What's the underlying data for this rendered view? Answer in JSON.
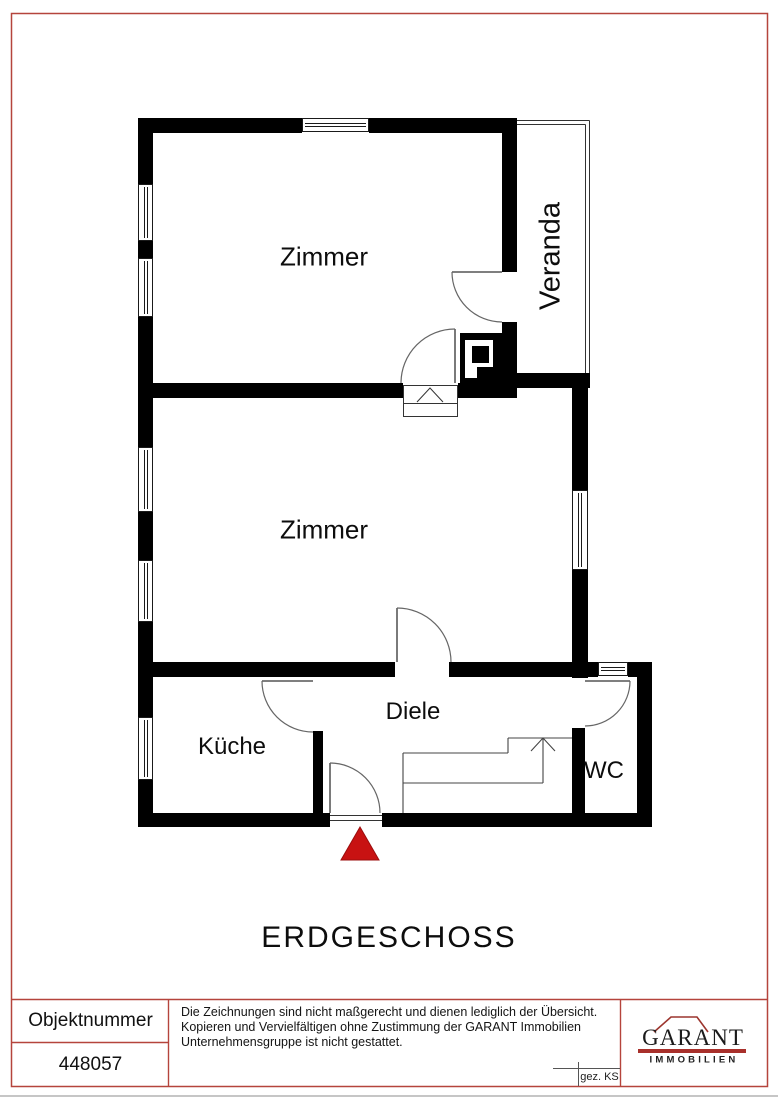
{
  "page": {
    "background": "#ffffff",
    "border_color": "#b5443c",
    "wall_color": "#000000"
  },
  "plan": {
    "title": "ERDGESCHOSS",
    "rooms": [
      {
        "id": "zimmer-top",
        "label": "Zimmer"
      },
      {
        "id": "veranda",
        "label": "Veranda"
      },
      {
        "id": "zimmer-middle",
        "label": "Zimmer"
      },
      {
        "id": "kueche",
        "label": "Küche"
      },
      {
        "id": "diele",
        "label": "Diele"
      },
      {
        "id": "wc",
        "label": "WC"
      }
    ],
    "entrance_marker_color": "#c81212"
  },
  "footer": {
    "object_number_label": "Objektnummer",
    "object_number_value": "448057",
    "disclaimer_lines": [
      "Die Zeichnungen sind nicht maßgerecht und dienen lediglich der Übersicht.",
      "Kopieren und Vervielfältigen ohne Zustimmung der GARANT Immobilien",
      "Unternehmensgruppe ist nicht gestattet."
    ],
    "drawn_by": "gez. KS",
    "logo": {
      "name": "GARANT",
      "subtitle": "IMMOBILIEN",
      "accent_color": "#a8302b"
    }
  }
}
